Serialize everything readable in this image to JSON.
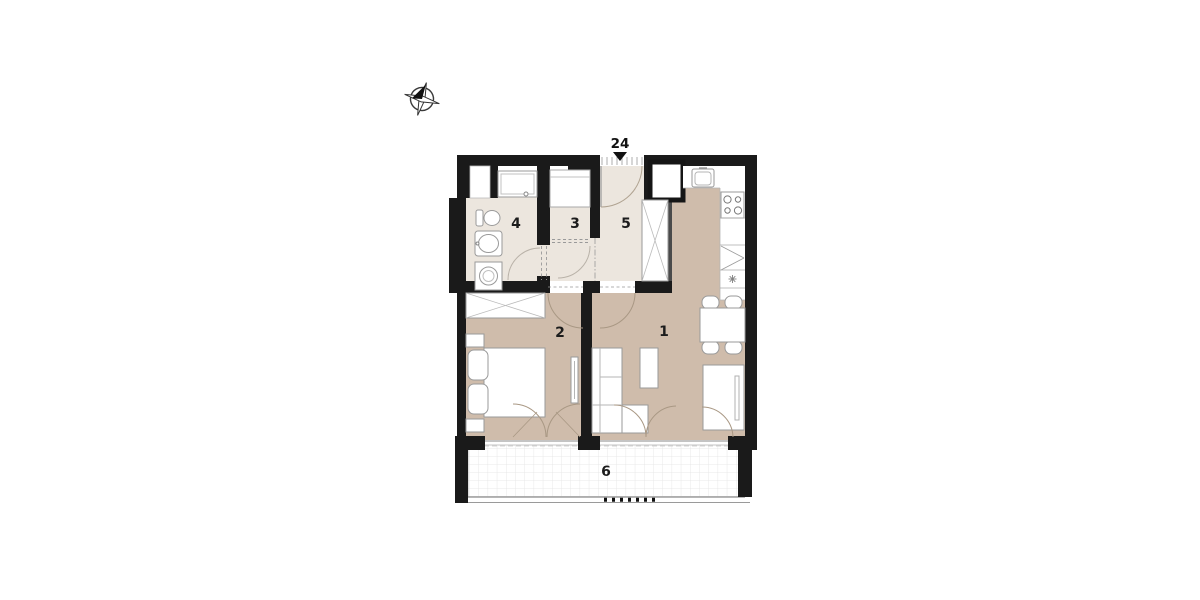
{
  "entrance_marker": {
    "label": "24",
    "icon": "down-triangle-icon"
  },
  "compass": {
    "icon": "compass-rose-icon"
  },
  "room_labels": {
    "living_kitchen": "1",
    "bedroom": "2",
    "room3": "3",
    "bathroom": "4",
    "hall": "5",
    "terrace": "6"
  },
  "colors": {
    "wall": "#1a1a1a",
    "floor_main": "#cfbcab",
    "floor_wet": "#ece6de",
    "furniture_fill": "#ffffff",
    "furniture_stroke": "#9a9a9a",
    "terrace_grid": "#e3e3e3",
    "door_arc": "#a99884",
    "background": "#ffffff"
  }
}
